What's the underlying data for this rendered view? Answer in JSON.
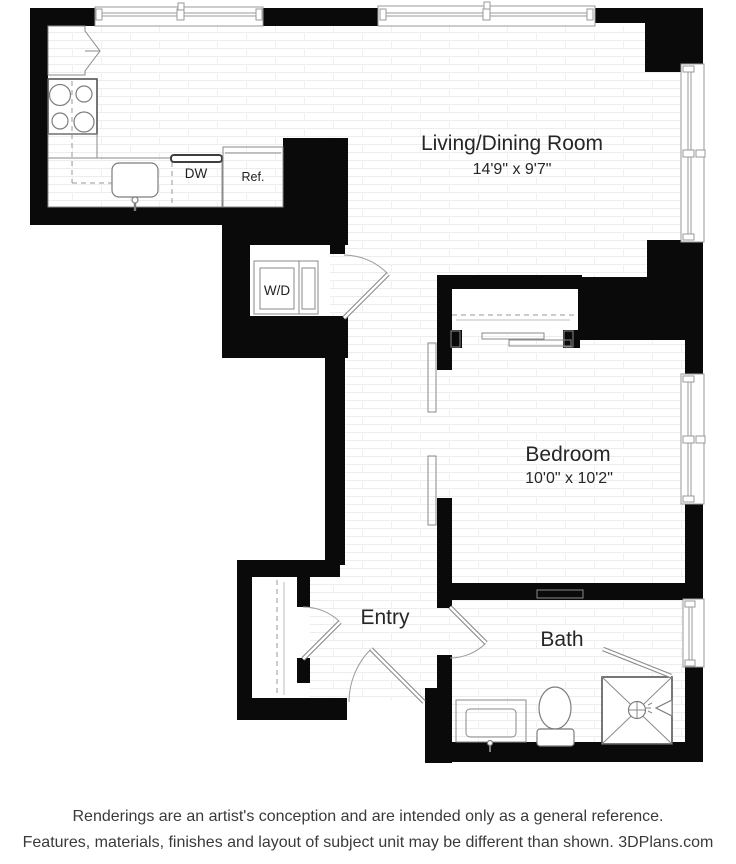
{
  "plan": {
    "rooms": {
      "living": {
        "name": "Living/Dining Room",
        "dims": "14'9\" x 9'7\""
      },
      "bedroom": {
        "name": "Bedroom",
        "dims": "10'0\" x 10'2\""
      },
      "entry": {
        "name": "Entry"
      },
      "bath": {
        "name": "Bath"
      }
    },
    "fixtures": {
      "washer_dryer": "W/D",
      "dishwasher": "DW",
      "refrigerator": "Ref."
    },
    "colors": {
      "wall": "#0a0a0a",
      "line": "#8a8a8a",
      "label": "#262626"
    }
  },
  "footer": {
    "line1": "Renderings are an artist's conception and are intended only as a general reference.",
    "line2": "Features, materials, finishes and layout of subject unit may be different than shown. 3DPlans.com"
  }
}
